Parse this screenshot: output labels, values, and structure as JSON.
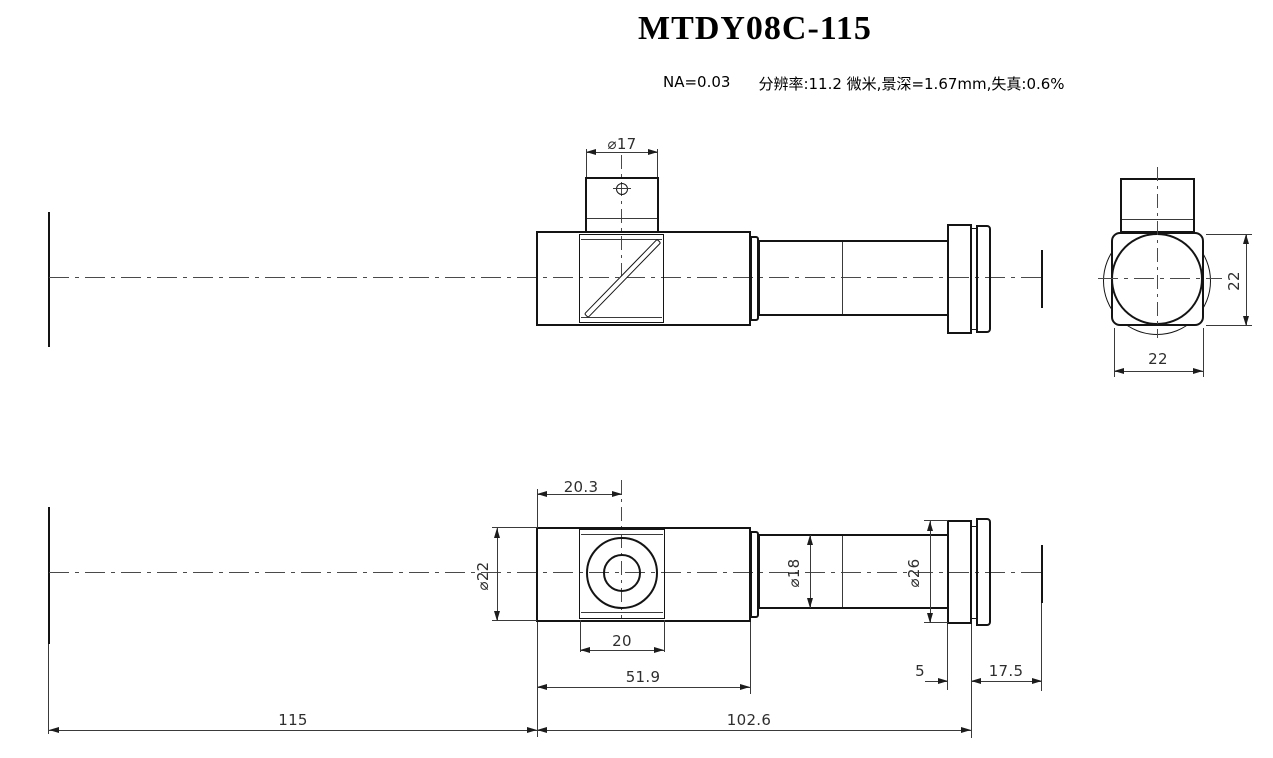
{
  "title": "MTDY08C-115",
  "specs": {
    "na": "NA=0.03",
    "detail": "分辨率:11.2 微米,景深=1.67mm,失真:0.6%"
  },
  "dims": {
    "side": {
      "port_dia": "⌀17"
    },
    "end": {
      "width": "22",
      "height": "22"
    },
    "bottom": {
      "port_offset": "20.3",
      "body_dia": "⌀22",
      "plate_width": "20",
      "body_length": "51.9",
      "left_total": "115",
      "right_total": "102.6",
      "tube_dia": "⌀18",
      "flange_dia": "⌀26",
      "flange_thickness": "5",
      "flange_to_image": "17.5"
    }
  }
}
